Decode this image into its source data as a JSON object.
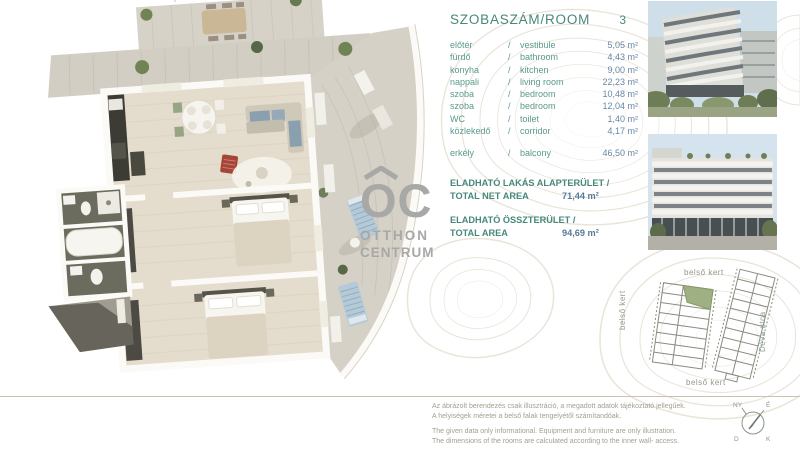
{
  "colors": {
    "teal": "#5a9a8c",
    "teal_dark": "#47887a",
    "value_blue": "#6787a5",
    "value_dark": "#58799a",
    "logo_gray": "#a8a8a6",
    "divider": "#c9c2af",
    "disclaimer": "#a29f90",
    "site_label": "#95988a",
    "deva": "#84a096",
    "contour": "#dbd2bf",
    "highlight_unit_green": "#9fb183"
  },
  "logo": {
    "mark": "OC",
    "line1": "OTTHON",
    "line2": "CENTRUM"
  },
  "room_table": {
    "title": "SZOBASZÁM/ROOM",
    "room_count": "3",
    "separator": "/",
    "rows": [
      {
        "hu": "előtér",
        "en": "vestibule",
        "area": "5,05 m²"
      },
      {
        "hu": "fürdő",
        "en": "bathroom",
        "area": "4,43 m²"
      },
      {
        "hu": "konyha",
        "en": "kitchen",
        "area": "9,00 m²"
      },
      {
        "hu": "nappali",
        "en": "living room",
        "area": "22,23 m²"
      },
      {
        "hu": "szoba",
        "en": "bedroom",
        "area": "10,48 m²"
      },
      {
        "hu": "szoba",
        "en": "bedroom",
        "area": "12,04 m²"
      },
      {
        "hu": "WC",
        "en": "toilet",
        "area": "1,40 m²"
      },
      {
        "hu": "közlekedő",
        "en": "corridor",
        "area": "4,17 m²"
      }
    ],
    "balcony_row": {
      "hu": "erkély",
      "en": "balcony",
      "area": "46,50 m²"
    }
  },
  "totals": [
    {
      "label_hu": "ELADHATÓ LAKÁS ALAPTERÜLET /",
      "label_en": "TOTAL  NET AREA",
      "value": "71,44 m²"
    },
    {
      "label_hu": "ELADHATÓ ÖSSZTERÜLET /",
      "label_en": "TOTAL AREA",
      "value": "94,69 m²"
    }
  ],
  "site_plan": {
    "label_top": "belső kert",
    "label_left": "belső kert",
    "label_bottom": "belső kert",
    "label_right": "Déva utca"
  },
  "compass": {
    "top_left": "NY",
    "top_right": "É",
    "bottom_left": "D",
    "bottom_right": "K"
  },
  "disclaimer": {
    "hu_line1": "Az ábrázolt berendezés csak illusztráció, a megadott adatok tájékoztató jellegűek.",
    "hu_line2": "A helyiségek méretei a belső falak tengelyétől számítandóak.",
    "en_line1": "The given data only informational. Equipment and furniture are only illustration.",
    "en_line2": "The dimensions of the rooms are calculated according to the inner wall- access."
  }
}
